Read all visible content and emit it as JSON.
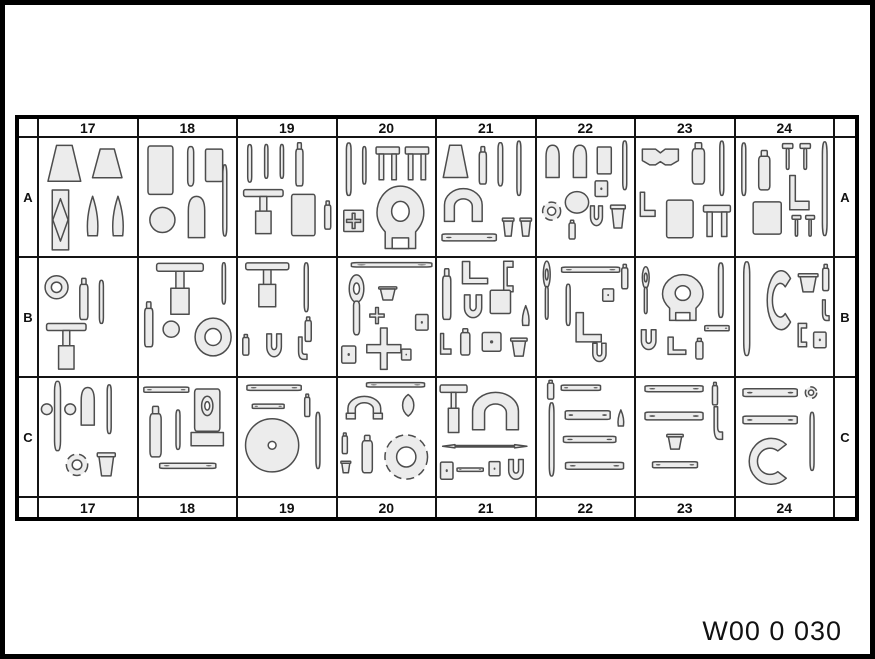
{
  "caption": "W00 0 030",
  "table": {
    "columns": [
      "17",
      "18",
      "19",
      "20",
      "21",
      "22",
      "23",
      "24"
    ],
    "rows": [
      "A",
      "B",
      "C"
    ]
  },
  "colors": {
    "background": "#ffffff",
    "frame": "#000000",
    "grid_line": "#141414",
    "tool_fill": "#ececec",
    "tool_outline": "#4d4d4d",
    "text": "#111111"
  },
  "glyph_legend": {
    "trap": "trapezoid-block-icon",
    "rect": "rect-block-icon",
    "tomb": "round-top-block-icon",
    "bar": "slim-bar-icon",
    "hbar": "mounting-plate-icon",
    "sq": "small-box-icon",
    "circ": "disc-icon",
    "ring": "ring-icon",
    "dring": "dashed-ring-icon",
    "disc": "large-disc-icon",
    "horseshoe": "horseshoe-bridge-icon",
    "yoke": "yoke-puller-icon",
    "wrench": "ring-wrench-icon",
    "fork": "open-end-wrench-icon",
    "tpull": "t-puller-icon",
    "cross": "cross-tool-icon",
    "cup": "cup-icon",
    "cone": "cone-icon",
    "flask": "bottle-icon",
    "dfr": "diamond-frame-icon",
    "lbrkt": "l-bracket-icon",
    "ubrkt": "u-bracket-icon",
    "clamp": "c-clamp-icon",
    "hook": "j-hook-icon",
    "chook": "c-hook-icon",
    "leaf": "leaf-gauge-icon",
    "uframe": "u-frame-icon",
    "cam": "block-with-ring-icon",
    "bowtie": "bowtie-block-icon",
    "xbox": "cross-box-icon",
    "tpin": "t-pin-icon",
    "dbar": "double-arrow-bar-icon"
  },
  "cells": {
    "A17": [
      [
        "trap",
        6,
        6,
        40,
        40
      ],
      [
        "trap",
        52,
        10,
        36,
        32
      ],
      [
        "dfr",
        8,
        52,
        28,
        64
      ],
      [
        "cone",
        44,
        58,
        22,
        44
      ],
      [
        "cone",
        70,
        58,
        22,
        44
      ]
    ],
    "A18": [
      [
        "rect",
        6,
        6,
        32,
        54
      ],
      [
        "bar",
        44,
        8,
        18,
        42
      ],
      [
        "rect",
        66,
        10,
        22,
        36
      ],
      [
        "circ",
        10,
        70,
        28,
        28
      ],
      [
        "tomb",
        44,
        58,
        30,
        46
      ],
      [
        "bar",
        82,
        26,
        12,
        76
      ]
    ],
    "A19": [
      [
        "bar",
        6,
        6,
        12,
        40
      ],
      [
        "bar",
        24,
        6,
        10,
        36
      ],
      [
        "bar",
        40,
        6,
        10,
        36
      ],
      [
        "flask",
        56,
        4,
        14,
        46
      ],
      [
        "tpull",
        4,
        50,
        44,
        50
      ],
      [
        "rect",
        52,
        56,
        30,
        46
      ],
      [
        "flask",
        86,
        64,
        12,
        30
      ]
    ],
    "A20": [
      [
        "bar",
        4,
        4,
        14,
        56
      ],
      [
        "bar",
        22,
        8,
        10,
        40
      ],
      [
        "ubrkt",
        38,
        6,
        26,
        40
      ],
      [
        "ubrkt",
        68,
        6,
        26,
        40
      ],
      [
        "xbox",
        4,
        72,
        24,
        26
      ],
      [
        "yoke",
        34,
        48,
        60,
        68
      ]
    ],
    "A21": [
      [
        "trap",
        4,
        6,
        30,
        36
      ],
      [
        "flask",
        40,
        8,
        14,
        40
      ],
      [
        "bar",
        58,
        4,
        14,
        46
      ],
      [
        "bar",
        78,
        2,
        12,
        58
      ],
      [
        "horseshoe",
        4,
        46,
        46,
        42
      ],
      [
        "hbar",
        4,
        94,
        58,
        16
      ],
      [
        "cup",
        66,
        80,
        14,
        22
      ],
      [
        "cup",
        84,
        80,
        14,
        22
      ]
    ],
    "A22": [
      [
        "tomb",
        4,
        6,
        24,
        36
      ],
      [
        "tomb",
        32,
        6,
        24,
        36
      ],
      [
        "rect",
        60,
        8,
        18,
        30
      ],
      [
        "bar",
        84,
        2,
        12,
        52
      ],
      [
        "sq",
        58,
        42,
        16,
        20
      ],
      [
        "circ",
        28,
        54,
        26,
        24
      ],
      [
        "dring",
        4,
        64,
        22,
        22
      ],
      [
        "flask",
        30,
        84,
        12,
        20
      ],
      [
        "fork",
        52,
        68,
        18,
        26
      ],
      [
        "cup",
        74,
        66,
        18,
        28
      ]
    ],
    "A23": [
      [
        "bowtie",
        4,
        8,
        42,
        28
      ],
      [
        "flask",
        52,
        4,
        24,
        44
      ],
      [
        "bar",
        82,
        2,
        12,
        58
      ],
      [
        "lbrkt",
        2,
        54,
        20,
        28
      ],
      [
        "rect",
        28,
        62,
        34,
        42
      ],
      [
        "ubrkt",
        68,
        66,
        30,
        38
      ]
    ],
    "A24": [
      [
        "bar",
        2,
        4,
        12,
        56
      ],
      [
        "flask",
        18,
        12,
        22,
        42
      ],
      [
        "tpin",
        46,
        4,
        14,
        30
      ],
      [
        "tpin",
        64,
        4,
        14,
        30
      ],
      [
        "bar",
        84,
        2,
        14,
        100
      ],
      [
        "lbrkt",
        52,
        36,
        26,
        40
      ],
      [
        "rect",
        14,
        64,
        36,
        36
      ],
      [
        "tpin",
        56,
        78,
        12,
        24
      ],
      [
        "tpin",
        70,
        78,
        12,
        24
      ]
    ],
    "B17": [
      [
        "ring",
        4,
        16,
        28,
        28
      ],
      [
        "flask",
        38,
        20,
        16,
        44
      ],
      [
        "bar",
        58,
        22,
        12,
        46
      ],
      [
        "tpull",
        6,
        64,
        44,
        52
      ]
    ],
    "B18": [
      [
        "flask",
        2,
        44,
        16,
        48
      ],
      [
        "tpull",
        16,
        2,
        52,
        58
      ],
      [
        "circ",
        24,
        64,
        18,
        18
      ],
      [
        "ring",
        54,
        58,
        44,
        46
      ],
      [
        "bar",
        82,
        4,
        10,
        44
      ]
    ],
    "B19": [
      [
        "tpull",
        6,
        2,
        48,
        50
      ],
      [
        "bar",
        64,
        4,
        12,
        52
      ],
      [
        "flask",
        66,
        60,
        12,
        26
      ],
      [
        "flask",
        2,
        78,
        12,
        22
      ],
      [
        "fork",
        26,
        76,
        22,
        30
      ],
      [
        "hook",
        56,
        80,
        18,
        26
      ]
    ],
    "B20": [
      [
        "hbar",
        12,
        2,
        86,
        10
      ],
      [
        "wrench",
        2,
        16,
        34,
        64
      ],
      [
        "cup",
        40,
        28,
        22,
        16
      ],
      [
        "cross",
        32,
        50,
        16,
        18
      ],
      [
        "cross",
        28,
        70,
        38,
        46
      ],
      [
        "sq",
        78,
        56,
        16,
        20
      ],
      [
        "sq",
        2,
        88,
        18,
        22
      ],
      [
        "sq",
        64,
        92,
        12,
        14
      ]
    ],
    "B21": [
      [
        "lbrkt",
        22,
        2,
        34,
        26
      ],
      [
        "clamp",
        62,
        2,
        20,
        34
      ],
      [
        "flask",
        2,
        10,
        16,
        54
      ],
      [
        "fork",
        24,
        36,
        26,
        30
      ],
      [
        "rect",
        52,
        32,
        26,
        26
      ],
      [
        "cone",
        84,
        48,
        14,
        22
      ],
      [
        "flask",
        20,
        72,
        18,
        28
      ],
      [
        "sq",
        44,
        74,
        24,
        24
      ],
      [
        "lbrkt",
        2,
        76,
        14,
        24
      ],
      [
        "cup",
        74,
        80,
        20,
        22
      ]
    ],
    "B22": [
      [
        "wrench",
        2,
        2,
        16,
        62
      ],
      [
        "hbar",
        24,
        6,
        62,
        12
      ],
      [
        "bar",
        26,
        26,
        12,
        44
      ],
      [
        "lbrkt",
        36,
        54,
        34,
        34
      ],
      [
        "sq",
        66,
        30,
        14,
        16
      ],
      [
        "fork",
        54,
        86,
        20,
        24
      ],
      [
        "flask",
        84,
        6,
        12,
        26
      ]
    ],
    "B23": [
      [
        "wrench",
        2,
        8,
        16,
        50
      ],
      [
        "yoke",
        22,
        16,
        52,
        50
      ],
      [
        "bar",
        80,
        4,
        14,
        58
      ],
      [
        "fork",
        2,
        72,
        22,
        26
      ],
      [
        "lbrkt",
        30,
        80,
        24,
        20
      ],
      [
        "flask",
        58,
        82,
        14,
        22
      ],
      [
        "hbar",
        70,
        66,
        26,
        12
      ]
    ],
    "B24": [
      [
        "bar",
        2,
        2,
        18,
        100
      ],
      [
        "chook",
        26,
        8,
        34,
        72
      ],
      [
        "cup",
        62,
        14,
        24,
        22
      ],
      [
        "flask",
        86,
        6,
        12,
        28
      ],
      [
        "hook",
        84,
        42,
        14,
        24
      ],
      [
        "clamp",
        58,
        66,
        18,
        26
      ],
      [
        "sq",
        78,
        74,
        16,
        20
      ]
    ],
    "C17": [
      [
        "bar",
        10,
        2,
        18,
        74
      ],
      [
        "circ",
        2,
        26,
        12,
        12
      ],
      [
        "circ",
        26,
        26,
        12,
        12
      ],
      [
        "tomb",
        38,
        8,
        24,
        42
      ],
      [
        "bar",
        66,
        6,
        12,
        52
      ],
      [
        "dring",
        26,
        76,
        26,
        26
      ],
      [
        "cup",
        58,
        74,
        22,
        28
      ]
    ],
    "C18": [
      [
        "hbar",
        4,
        6,
        48,
        12
      ],
      [
        "flask",
        6,
        28,
        22,
        54
      ],
      [
        "bar",
        34,
        32,
        12,
        42
      ],
      [
        "cam",
        52,
        10,
        36,
        62
      ],
      [
        "hbar",
        20,
        84,
        60,
        12
      ]
    ],
    "C19": [
      [
        "hbar",
        8,
        4,
        58,
        12
      ],
      [
        "hbar",
        14,
        24,
        34,
        10
      ],
      [
        "flask",
        66,
        16,
        10,
        24
      ],
      [
        "disc",
        6,
        40,
        58,
        58
      ],
      [
        "bar",
        76,
        34,
        12,
        60
      ]
    ],
    "C20": [
      [
        "hbar",
        28,
        2,
        62,
        10
      ],
      [
        "uframe",
        6,
        16,
        42,
        36
      ],
      [
        "leaf",
        56,
        16,
        32,
        24
      ],
      [
        "flask",
        2,
        56,
        10,
        22
      ],
      [
        "cup",
        2,
        84,
        12,
        14
      ],
      [
        "flask",
        20,
        58,
        20,
        40
      ],
      [
        "dring",
        44,
        54,
        52,
        54
      ]
    ],
    "C21": [
      [
        "tpull",
        2,
        4,
        30,
        54
      ],
      [
        "horseshoe",
        32,
        8,
        56,
        48
      ],
      [
        "dbar",
        4,
        64,
        90,
        12
      ],
      [
        "sq",
        2,
        84,
        16,
        22
      ],
      [
        "hbar",
        20,
        90,
        28,
        8
      ],
      [
        "sq",
        52,
        84,
        14,
        18
      ],
      [
        "fork",
        70,
        82,
        22,
        26
      ]
    ],
    "C22": [
      [
        "flask",
        8,
        2,
        12,
        20
      ],
      [
        "hbar",
        24,
        4,
        42,
        12
      ],
      [
        "bar",
        8,
        24,
        14,
        78
      ],
      [
        "hbar",
        28,
        28,
        48,
        20
      ],
      [
        "hbar",
        26,
        56,
        56,
        14
      ],
      [
        "hbar",
        28,
        82,
        62,
        16
      ],
      [
        "cone",
        80,
        32,
        12,
        18
      ]
    ],
    "C23": [
      [
        "hbar",
        8,
        4,
        62,
        14
      ],
      [
        "flask",
        76,
        4,
        10,
        24
      ],
      [
        "hbar",
        8,
        30,
        62,
        18
      ],
      [
        "hook",
        74,
        28,
        18,
        38
      ],
      [
        "cup",
        30,
        56,
        20,
        18
      ],
      [
        "hbar",
        16,
        82,
        48,
        14
      ]
    ],
    "C24": [
      [
        "hbar",
        6,
        6,
        58,
        18
      ],
      [
        "dring",
        70,
        8,
        14,
        14
      ],
      [
        "hbar",
        6,
        34,
        58,
        18
      ],
      [
        "bar",
        72,
        34,
        12,
        62
      ],
      [
        "chook",
        4,
        58,
        54,
        56
      ]
    ]
  }
}
